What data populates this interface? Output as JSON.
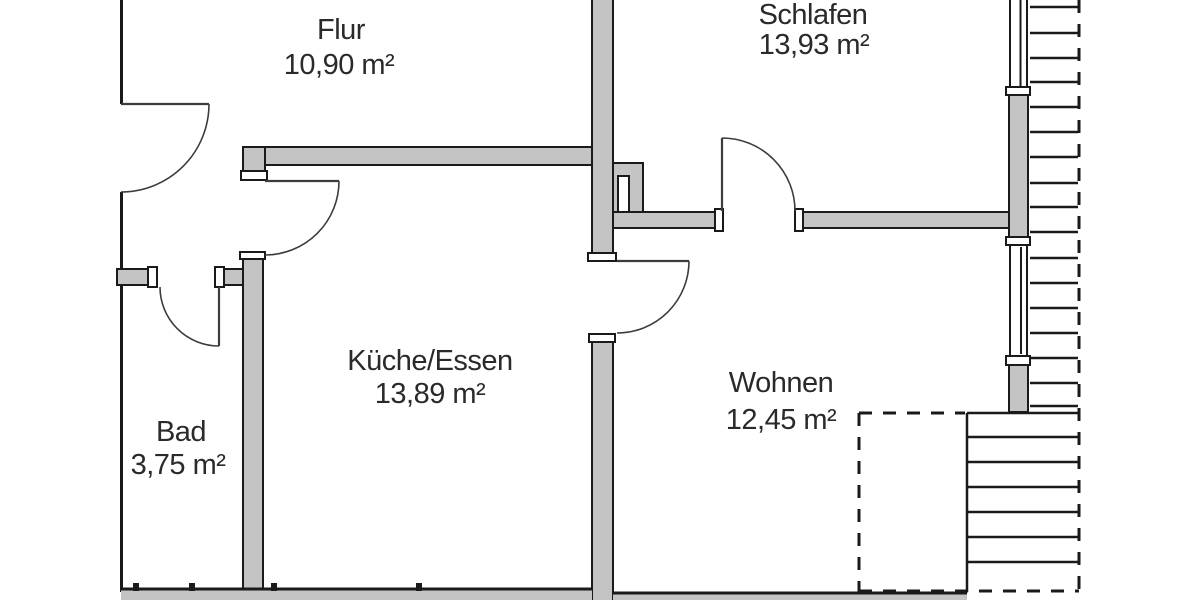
{
  "palette": {
    "wall_fill": "#c4c4c4",
    "line": "#1a1a1a",
    "door_line": "#3c3c3c",
    "text": "#2a2a2a",
    "background": "#ffffff"
  },
  "rooms": [
    {
      "id": "flur",
      "name": "Flur",
      "area": "10,90 m²"
    },
    {
      "id": "schlafen",
      "name": "Schlafen",
      "area": "13,93 m²"
    },
    {
      "id": "kueche",
      "name": "Küche/Essen",
      "area": "13,89 m²"
    },
    {
      "id": "wohnen",
      "name": "Wohnen",
      "area": "12,45 m²"
    },
    {
      "id": "bad",
      "name": "Bad",
      "area": "3,75 m²"
    }
  ]
}
